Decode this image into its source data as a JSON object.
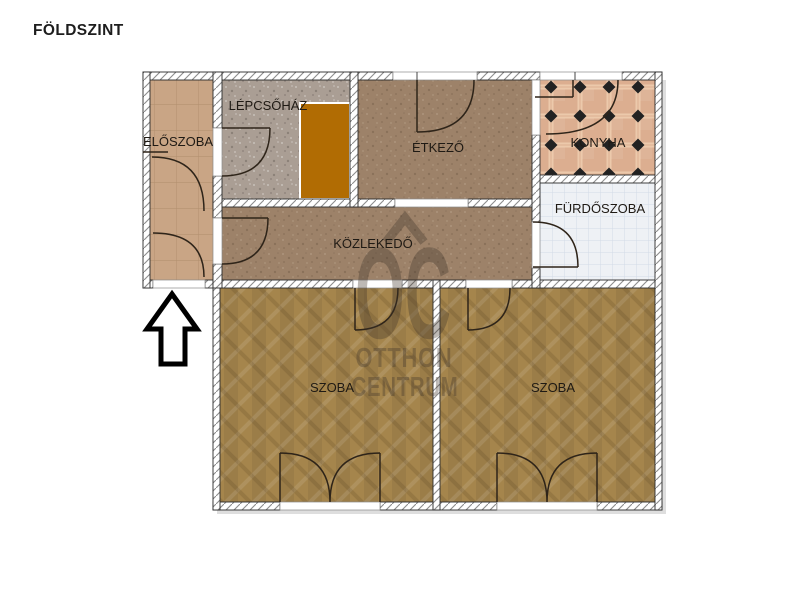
{
  "title": "FÖLDSZINT",
  "plan": {
    "rooms": [
      {
        "id": "eloszoba",
        "label": "ELŐSZOBA"
      },
      {
        "id": "lepcsohaz",
        "label": "LÉPCSŐHÁZ"
      },
      {
        "id": "etkezo",
        "label": "ÉTKEZŐ"
      },
      {
        "id": "konyha",
        "label": "KONYHA"
      },
      {
        "id": "furdoszoba",
        "label": "FÜRDŐSZOBA"
      },
      {
        "id": "kozlekedo",
        "label": "KÖZLEKEDŐ"
      },
      {
        "id": "szoba_left",
        "label": "SZOBA"
      },
      {
        "id": "szoba_right",
        "label": "SZOBA"
      }
    ],
    "watermark": {
      "logo": "OC",
      "line1": "OTTHON",
      "line2": "CENTRUM"
    },
    "colors": {
      "eloszoba_floor": "#c9a585",
      "lepcsohaz_floor": "#aa9e94",
      "etkezo_kozlekedo_floor": "#9d8269",
      "konyha_tile": "#dcae90",
      "konyha_diamond": "#222222",
      "furdoszoba_tile": "#eef1f5",
      "szoba_parquet": "#a5854c",
      "stairs": "#b16c03",
      "wall_fill": "#ffffff",
      "wall_line": "#2b2b2b",
      "door_line": "#2e2419",
      "watermark": "#3f342a",
      "title_text": "#1d1d1d"
    }
  }
}
